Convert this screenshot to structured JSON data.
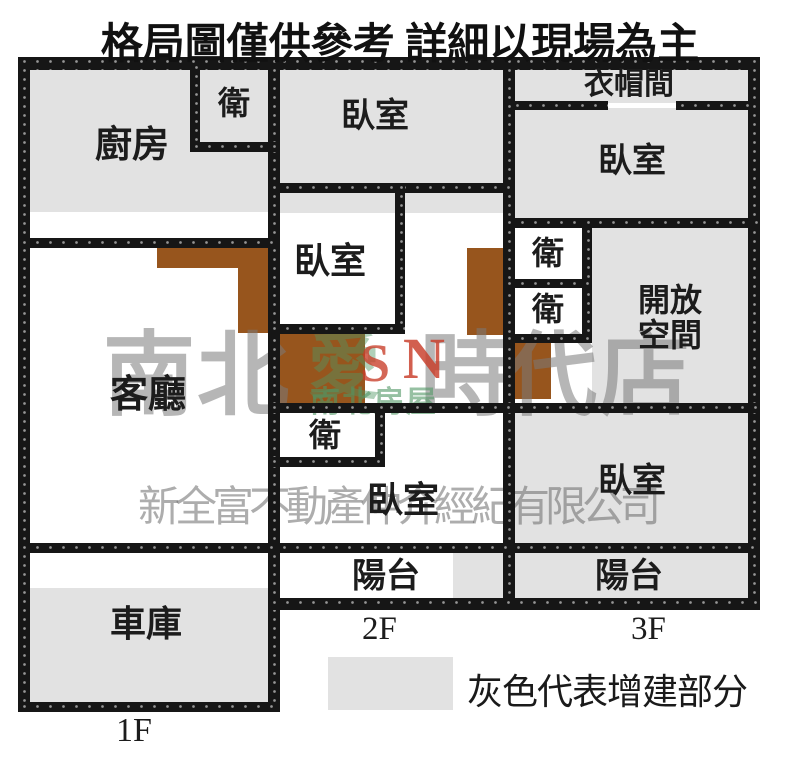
{
  "title": "格局圖僅供參考 詳細以現場為主",
  "plan": {
    "rooms": {
      "kitchen": "廚房",
      "bath": "衛",
      "bedroom": "臥室",
      "closet": "衣帽間",
      "open_space": [
        "開放",
        "空間"
      ],
      "living_room": "客廳",
      "balcony": "陽台",
      "garage": "車庫"
    },
    "floor_labels": {
      "f1": "1F",
      "f2": "2F",
      "f3": "3F"
    }
  },
  "legend": {
    "label": "灰色代表增建部分"
  },
  "watermark": {
    "brand_left_1": "南",
    "brand_left_2": "北",
    "brand_right_1": "時",
    "brand_right_2": "代",
    "brand_right_3": "店",
    "logo_char": "愛",
    "logo_s": "S",
    "logo_n": "N",
    "logo_subtext": "南北房屋",
    "company": "新全富不動產仲介經紀有限公司"
  },
  "colors": {
    "addition_gray": "#e2e2e2",
    "cabinet_brown": "#97551d",
    "wall_black": "#161616"
  }
}
